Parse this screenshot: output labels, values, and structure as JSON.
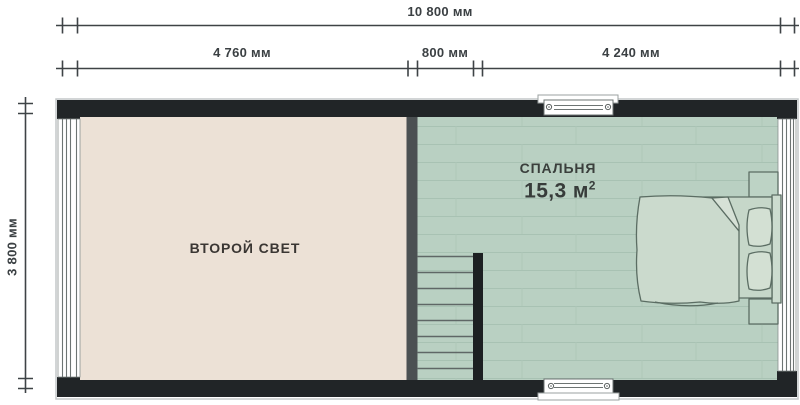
{
  "dimensions": {
    "total_width": "10 800 мм",
    "segment_left": "4 760 мм",
    "segment_center": "800 мм",
    "segment_right": "4 240 мм",
    "side_height": "3 800 мм"
  },
  "rooms": {
    "second_light": {
      "name": "ВТОРОЙ СВЕТ"
    },
    "bedroom": {
      "name": "СПАЛЬНЯ",
      "area": "15,3 м²",
      "area_value": "15,3 м",
      "area_superscript": "2"
    }
  },
  "fixtures": {
    "staircase_steps": 8,
    "windows": [
      "left",
      "top",
      "right",
      "bottom"
    ],
    "furniture": [
      "double-bed",
      "pillow",
      "pillow",
      "nightstand",
      "nightstand"
    ]
  },
  "colors": {
    "wall": "#212527",
    "partition_wall": "#4b5052",
    "stair_railing": "#1d2022",
    "second_light_floor": "#ece1d6",
    "bedroom_floor": "#b9d0c2",
    "plank_line": "#a8c2b3",
    "dimension_ink": "#3e4346",
    "furniture_outline": "#5b6d63",
    "window_frame": "#6d7473"
  }
}
